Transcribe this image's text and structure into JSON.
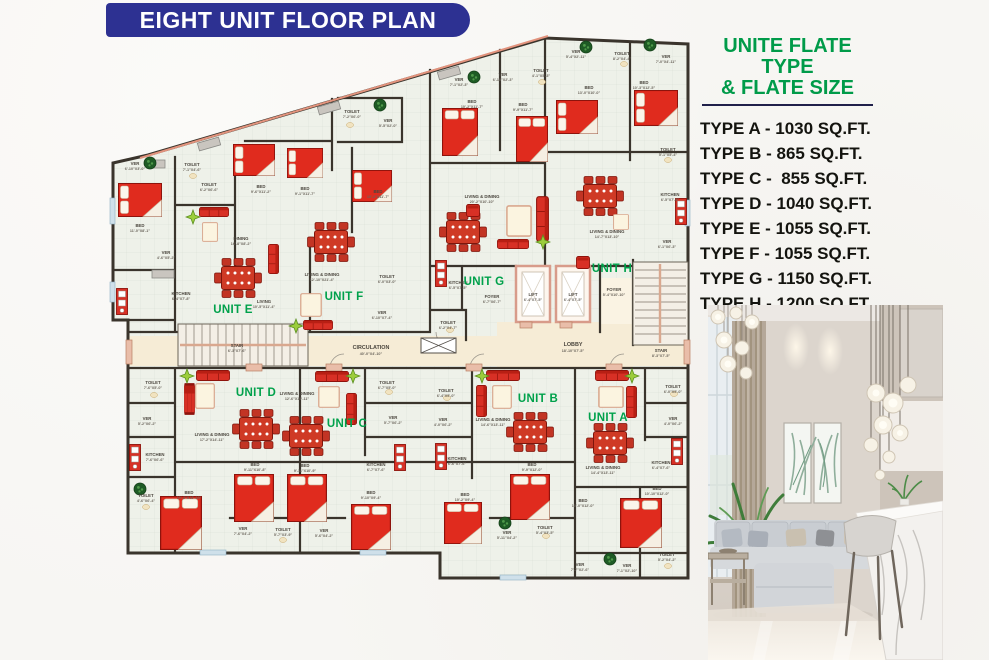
{
  "header": {
    "title": "EIGHT UNIT FLOOR PLAN"
  },
  "legend": {
    "title1": "UNITE FLATE TYPE",
    "title2": "& FLATE SIZE",
    "items": [
      "TYPE A - 1030 SQ.FT.",
      "TYPE B - 865 SQ.FT.",
      "TYPE C -  855 SQ.FT.",
      "TYPE D - 1040 SQ.FT.",
      "TYPE E - 1055 SQ.FT.",
      "TYPE F - 1055 SQ.FT.",
      "TYPE G - 1150 SQ.FT.",
      "TYPE H - 1200 SQ.FT."
    ]
  },
  "colors": {
    "banner_blue": "#2d3192",
    "legend_green": "#009b49",
    "unit_green": "#00a14b",
    "furniture_red": "#e02b1e",
    "wall_dark": "#3a342c",
    "corridor_cream": "#f6ecd6",
    "accent_salmon": "#e2937d"
  },
  "plan": {
    "units": [
      {
        "id": "A",
        "l": "UNIT A",
        "x": 608,
        "y": 421
      },
      {
        "id": "B",
        "l": "UNIT B",
        "x": 538,
        "y": 402
      },
      {
        "id": "C",
        "l": "UNIT C",
        "x": 347,
        "y": 427
      },
      {
        "id": "D",
        "l": "UNIT D",
        "x": 256,
        "y": 396
      },
      {
        "id": "E",
        "l": "UNIT E",
        "x": 233,
        "y": 313
      },
      {
        "id": "F",
        "l": "UNIT F",
        "x": 344,
        "y": 300
      },
      {
        "id": "G",
        "l": "UNIT G",
        "x": 484,
        "y": 285
      },
      {
        "id": "H",
        "l": "UNIT H",
        "x": 612,
        "y": 272
      }
    ],
    "rooms": [
      {
        "l": "VER",
        "d": "6'-10\"X3'-0\"",
        "x": 135,
        "y": 165
      },
      {
        "l": "TOILET",
        "d": "7'-1\"X4'-6\"",
        "x": 192,
        "y": 166
      },
      {
        "l": "TOILET",
        "d": "6'-2\"X6'-6\"",
        "x": 209,
        "y": 186
      },
      {
        "l": "BED",
        "d": "11'-0\"X8'-1\"",
        "x": 140,
        "y": 227
      },
      {
        "l": "VER",
        "d": "4'-6\"X5'-2\"",
        "x": 166,
        "y": 254
      },
      {
        "l": "KITCHEN",
        "d": "6'-4\"X7'-8\"",
        "x": 181,
        "y": 295
      },
      {
        "l": "DINING",
        "d": "16'-8\"X8'-2\"",
        "x": 241,
        "y": 240
      },
      {
        "l": "LIVING",
        "d": "10'-5\"X11'-4\"",
        "x": 264,
        "y": 303
      },
      {
        "l": "BED",
        "d": "9'-6\"X11'-2\"",
        "x": 261,
        "y": 188
      },
      {
        "l": "BED",
        "d": "9'-1\"X11'-7\"",
        "x": 305,
        "y": 190
      },
      {
        "l": "LIVING & DINING",
        "d": "12'-10\"X21'-4\"",
        "x": 322,
        "y": 276
      },
      {
        "l": "BED",
        "d": "10'-2\"X11'-7\"",
        "x": 378,
        "y": 193
      },
      {
        "l": "TOILET",
        "d": "7'-2\"X6'-0\"",
        "x": 352,
        "y": 113
      },
      {
        "l": "VER",
        "d": "5'-5\"X2'-0\"",
        "x": 388,
        "y": 122
      },
      {
        "l": "TOILET",
        "d": "6'-0\"X3'-0\"",
        "x": 387,
        "y": 278
      },
      {
        "l": "VER",
        "d": "6'-10\"X7'-4\"",
        "x": 382,
        "y": 314
      },
      {
        "l": "VER",
        "d": "7'-1\"X2'-3\"",
        "x": 459,
        "y": 81
      },
      {
        "l": "BED",
        "d": "10'-2\"X11'-7\"",
        "x": 472,
        "y": 103
      },
      {
        "l": "VER",
        "d": "6'-10\"X2'-3\"",
        "x": 503,
        "y": 76
      },
      {
        "l": "BED",
        "d": "9'-9\"X11'-7\"",
        "x": 523,
        "y": 106
      },
      {
        "l": "TOILET",
        "d": "4'-1\"X5'-3\"",
        "x": 541,
        "y": 72
      },
      {
        "l": "VER",
        "d": "5'-4\"X2'-11\"",
        "x": 576,
        "y": 53
      },
      {
        "l": "BED",
        "d": "13'-0\"X10'-0\"",
        "x": 589,
        "y": 89
      },
      {
        "l": "TOILET",
        "d": "8'-2\"X4'-4\"",
        "x": 622,
        "y": 55
      },
      {
        "l": "VER",
        "d": "7'-0\"X4'-11\"",
        "x": 666,
        "y": 58
      },
      {
        "l": "BED",
        "d": "10'-3\"X12'-5\"",
        "x": 644,
        "y": 84
      },
      {
        "l": "TOILET",
        "d": "5'-1\"X5'-4\"",
        "x": 668,
        "y": 151
      },
      {
        "l": "KITCHEN",
        "d": "6'-5\"X7'-9\"",
        "x": 670,
        "y": 196
      },
      {
        "l": "LIVING & DINING",
        "d": "20'-2\"X10'-10\"",
        "x": 482,
        "y": 198
      },
      {
        "l": "LIVING & DINING",
        "d": "14'-7\"X13'-10\"",
        "x": 607,
        "y": 233
      },
      {
        "l": "VER",
        "d": "6'-1\"X6'-3\"",
        "x": 667,
        "y": 243
      },
      {
        "l": "KITCHEN",
        "d": "6'-5\"X7'-5\"",
        "x": 458,
        "y": 284
      },
      {
        "l": "FOYER",
        "d": "6'-7\"X6'-7\"",
        "x": 492,
        "y": 298
      },
      {
        "l": "TOILET",
        "d": "6'-2\"X4'-7\"",
        "x": 448,
        "y": 324
      },
      {
        "l": "LIFT",
        "d": "6'-4\"X7'-5\"",
        "x": 533,
        "y": 296
      },
      {
        "l": "LIFT",
        "d": "6'-4\"X7'-5\"",
        "x": 573,
        "y": 296
      },
      {
        "l": "FOYER",
        "d": "5'-4\"X10'-10\"",
        "x": 614,
        "y": 291
      },
      {
        "l": "LOBBY",
        "d": "18'-10\"X7'-5\"",
        "x": 573,
        "y": 346,
        "b": 1
      },
      {
        "l": "STAIR",
        "d": "6'-3\"X7'-6\"",
        "x": 237,
        "y": 347
      },
      {
        "l": "STAIR",
        "d": "8'-3\"X7'-5\"",
        "x": 661,
        "y": 352
      },
      {
        "l": "CIRCULATION",
        "d": "40'-0\"X4'-10\"",
        "x": 371,
        "y": 349,
        "b": 1
      },
      {
        "l": "TOILET",
        "d": "7'-6\"X5'-0\"",
        "x": 153,
        "y": 384
      },
      {
        "l": "VER",
        "d": "5'-2\"X6'-2\"",
        "x": 147,
        "y": 420
      },
      {
        "l": "KITCHEN",
        "d": "7'-6\"X6'-6\"",
        "x": 155,
        "y": 456
      },
      {
        "l": "TOILET",
        "d": "4'-6\"X6'-4\"",
        "x": 146,
        "y": 497
      },
      {
        "l": "LIVING & DINING",
        "d": "17'-2\"X14'-11\"",
        "x": 212,
        "y": 436
      },
      {
        "l": "BED",
        "d": "10'-3\"X13'-10\"",
        "x": 189,
        "y": 494
      },
      {
        "l": "BED",
        "d": "9'-11\"X10'-8\"",
        "x": 255,
        "y": 466
      },
      {
        "l": "LIVING & DINING",
        "d": "12'-6\"X19'-11\"",
        "x": 297,
        "y": 395
      },
      {
        "l": "BED",
        "d": "9'-11\"X10'-9\"",
        "x": 305,
        "y": 467
      },
      {
        "l": "TOILET",
        "d": "6'-7\"X5'-0\"",
        "x": 387,
        "y": 384
      },
      {
        "l": "VER",
        "d": "5'-7\"X6'-2\"",
        "x": 393,
        "y": 419
      },
      {
        "l": "KITCHEN",
        "d": "6'-7\"X7'-6\"",
        "x": 376,
        "y": 466
      },
      {
        "l": "BED",
        "d": "9'-10\"X9'-4\"",
        "x": 371,
        "y": 494
      },
      {
        "l": "TOILET",
        "d": "6'-4\"X5'-0\"",
        "x": 446,
        "y": 392
      },
      {
        "l": "VER",
        "d": "4'-0\"X6'-2\"",
        "x": 443,
        "y": 421
      },
      {
        "l": "KITCHEN",
        "d": "6'-6\"X7'-6\"",
        "x": 457,
        "y": 460
      },
      {
        "l": "LIVING & DINING",
        "d": "14'-6\"X13'-11\"",
        "x": 493,
        "y": 421
      },
      {
        "l": "BED",
        "d": "10'-2\"X9'-4\"",
        "x": 465,
        "y": 496
      },
      {
        "l": "BED",
        "d": "9'-9\"X12'-0\"",
        "x": 532,
        "y": 466
      },
      {
        "l": "LIVING & DINING",
        "d": "14'-4\"X13'-11\"",
        "x": 603,
        "y": 469
      },
      {
        "l": "BED",
        "d": "10'-0\"X12'-0\"",
        "x": 583,
        "y": 502
      },
      {
        "l": "BED",
        "d": "10'-10\"X12'-0\"",
        "x": 657,
        "y": 490
      },
      {
        "l": "TOILET",
        "d": "6'-0\"X5'-0\"",
        "x": 673,
        "y": 388
      },
      {
        "l": "VER",
        "d": "4'-0\"X6'-2\"",
        "x": 673,
        "y": 420
      },
      {
        "l": "KITCHEN",
        "d": "6'-4\"X7'-6\"",
        "x": 661,
        "y": 464
      },
      {
        "l": "VER",
        "d": "7'-6\"X4'-2\"",
        "x": 243,
        "y": 530
      },
      {
        "l": "TOILET",
        "d": "5'-7\"X3'-9\"",
        "x": 283,
        "y": 531
      },
      {
        "l": "VER",
        "d": "5'-6\"X4'-2\"",
        "x": 324,
        "y": 532
      },
      {
        "l": "VER",
        "d": "5'-11\"X4'-2\"",
        "x": 507,
        "y": 534
      },
      {
        "l": "TOILET",
        "d": "5'-4\"X3'-5\"",
        "x": 545,
        "y": 529
      },
      {
        "l": "VER",
        "d": "7'-7\"X2'-6\"",
        "x": 580,
        "y": 566
      },
      {
        "l": "VER",
        "d": "7'-1\"X2'-10\"",
        "x": 627,
        "y": 567
      },
      {
        "l": "TOILET",
        "d": "5'-2\"X4'-2\"",
        "x": 667,
        "y": 556
      }
    ]
  }
}
